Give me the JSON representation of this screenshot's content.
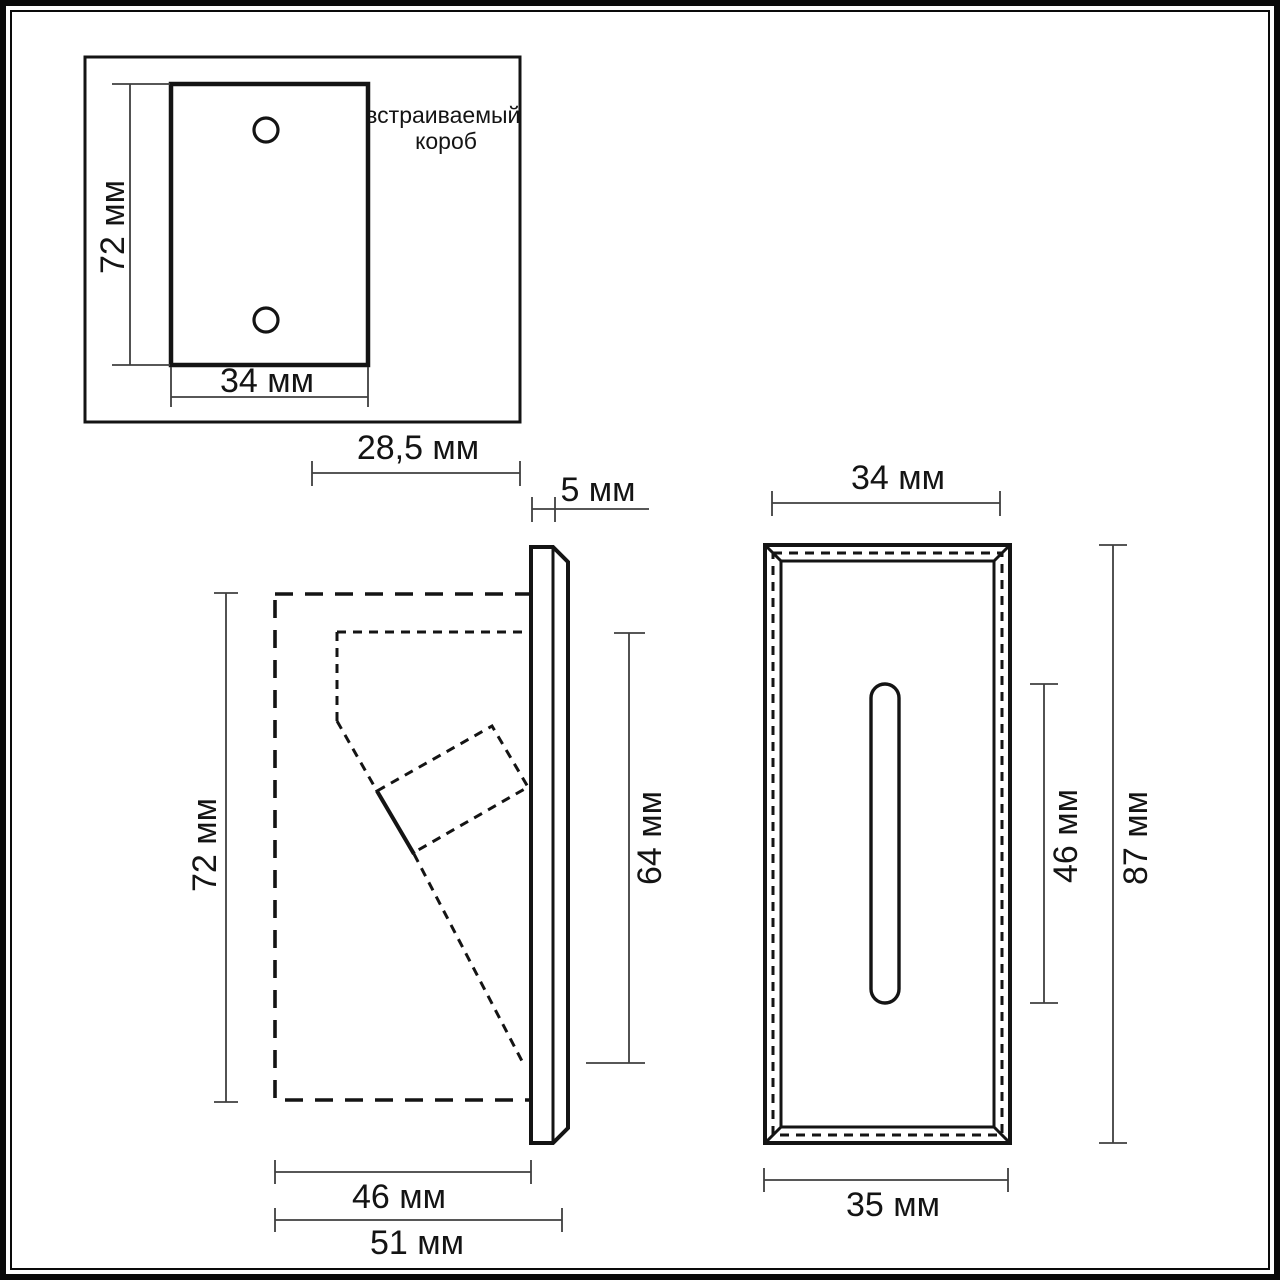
{
  "views": {
    "mounting_box": {
      "label_line1": "встраиваемый",
      "label_line2": "короб",
      "dim_height": "72 мм",
      "dim_width": "34 мм"
    },
    "side_section": {
      "dim_recess_depth": "28,5 мм",
      "dim_protrusion": "5 мм",
      "dim_height": "72 мм",
      "dim_visible_height": "64 мм",
      "dim_body_width": "46 мм",
      "dim_overall_width": "51 мм"
    },
    "front_view": {
      "dim_width_top": "34 мм",
      "dim_slot_height": "46 мм",
      "dim_height": "87 мм",
      "dim_width_bottom": "35 мм"
    }
  },
  "colors": {
    "line": "#141414",
    "dimension_line": "#3f3f3f",
    "frame": "#0a0a0a",
    "background": "#ffffff"
  }
}
